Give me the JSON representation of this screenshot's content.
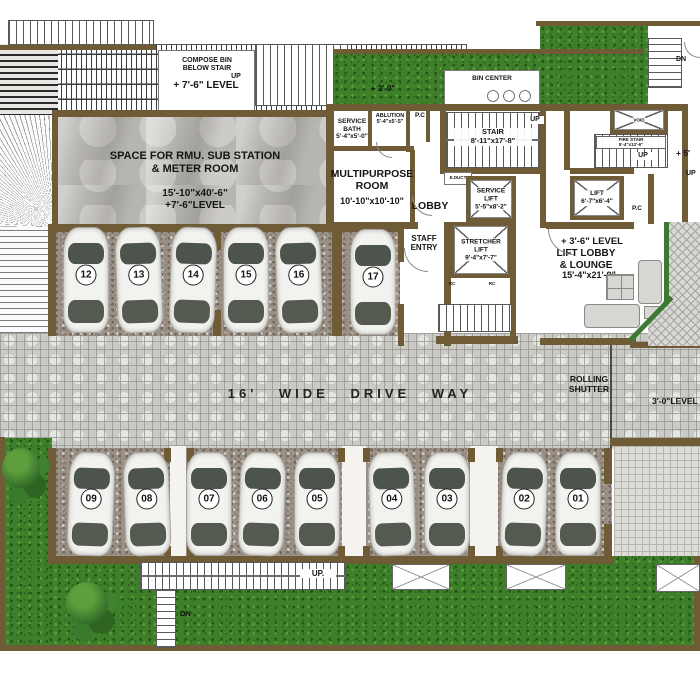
{
  "title": "Ground level parking and lift lobby floor plan",
  "colors": {
    "wall": "#6f5c36",
    "grass": "#3e7f2a",
    "gravel": "#9b9186",
    "driveway": "#cbcac5",
    "concrete": "#b7b5b0",
    "glass_wall": "#3c7a33"
  },
  "labels": {
    "compose_bin": "COMPOSE BIN\nBELOW STAIR",
    "compose_level": "+ 7'-6\" LEVEL",
    "compose_up": "UP",
    "level_2_0": "+ 2'-0\"",
    "bin_center": "BIN CENTER",
    "dn_top_right": "DN",
    "service_bath": "SERVICE\nBATH\n5'-4\"x5'-0\"",
    "ablution": "ABLUTION\n5'-4\"x5'-5\"",
    "pc_top": "P.C",
    "stair_main": "STAIR\n8'-11\"x17'-8\"",
    "stair_up": "UP",
    "void": "VOID",
    "fire_stair": "FIRE STAIR\n5'-4\"x13'-6\"",
    "fire_up": "UP",
    "plus_5": "+ 5'",
    "right_up": "UP",
    "rmu_name": "SPACE FOR RMU. SUB STATION\n& METER ROOM",
    "rmu_dim": "15'-10\"x40'-6\"\n+7'-6\"LEVEL",
    "multipurpose": "MULTIPURPOSE\nROOM",
    "multipurpose_dim": "10'-10\"x10'-10\"",
    "lobby": "LOBBY",
    "educt": "E.DUCT",
    "service_lift": "SERVICE\nLIFT\n5'-5\"x8'-2\"",
    "lift": "LIFT\n6'-7\"x6'-4\"",
    "pc_right": "P.C",
    "staff_entry": "STAFF\nENTRY",
    "stretcher_lift": "STRETCHER\nLIFT\n9'-4\"x7'-7\"",
    "rc_left": "RC",
    "rc_right": "RC",
    "lounge_level": "+ 3'-6\" LEVEL",
    "lounge_name": "LIFT LOBBY\n& LOUNGE",
    "lounge_dim": "15'-4\"x21'-9\"",
    "driveway": "16' WIDE DRIVE WAY",
    "rolling_shutter": "ROLLING\nSHUTTER",
    "level_3_0": "3'-0\"LEVEL",
    "stair_bottom_up": "UP.",
    "dn_bottom": "DN"
  },
  "parking": {
    "top_row": [
      "12",
      "13",
      "14",
      "15",
      "16",
      "17"
    ],
    "bottom_row": [
      "09",
      "08",
      "07",
      "06",
      "05",
      "04",
      "03",
      "02",
      "01"
    ]
  }
}
